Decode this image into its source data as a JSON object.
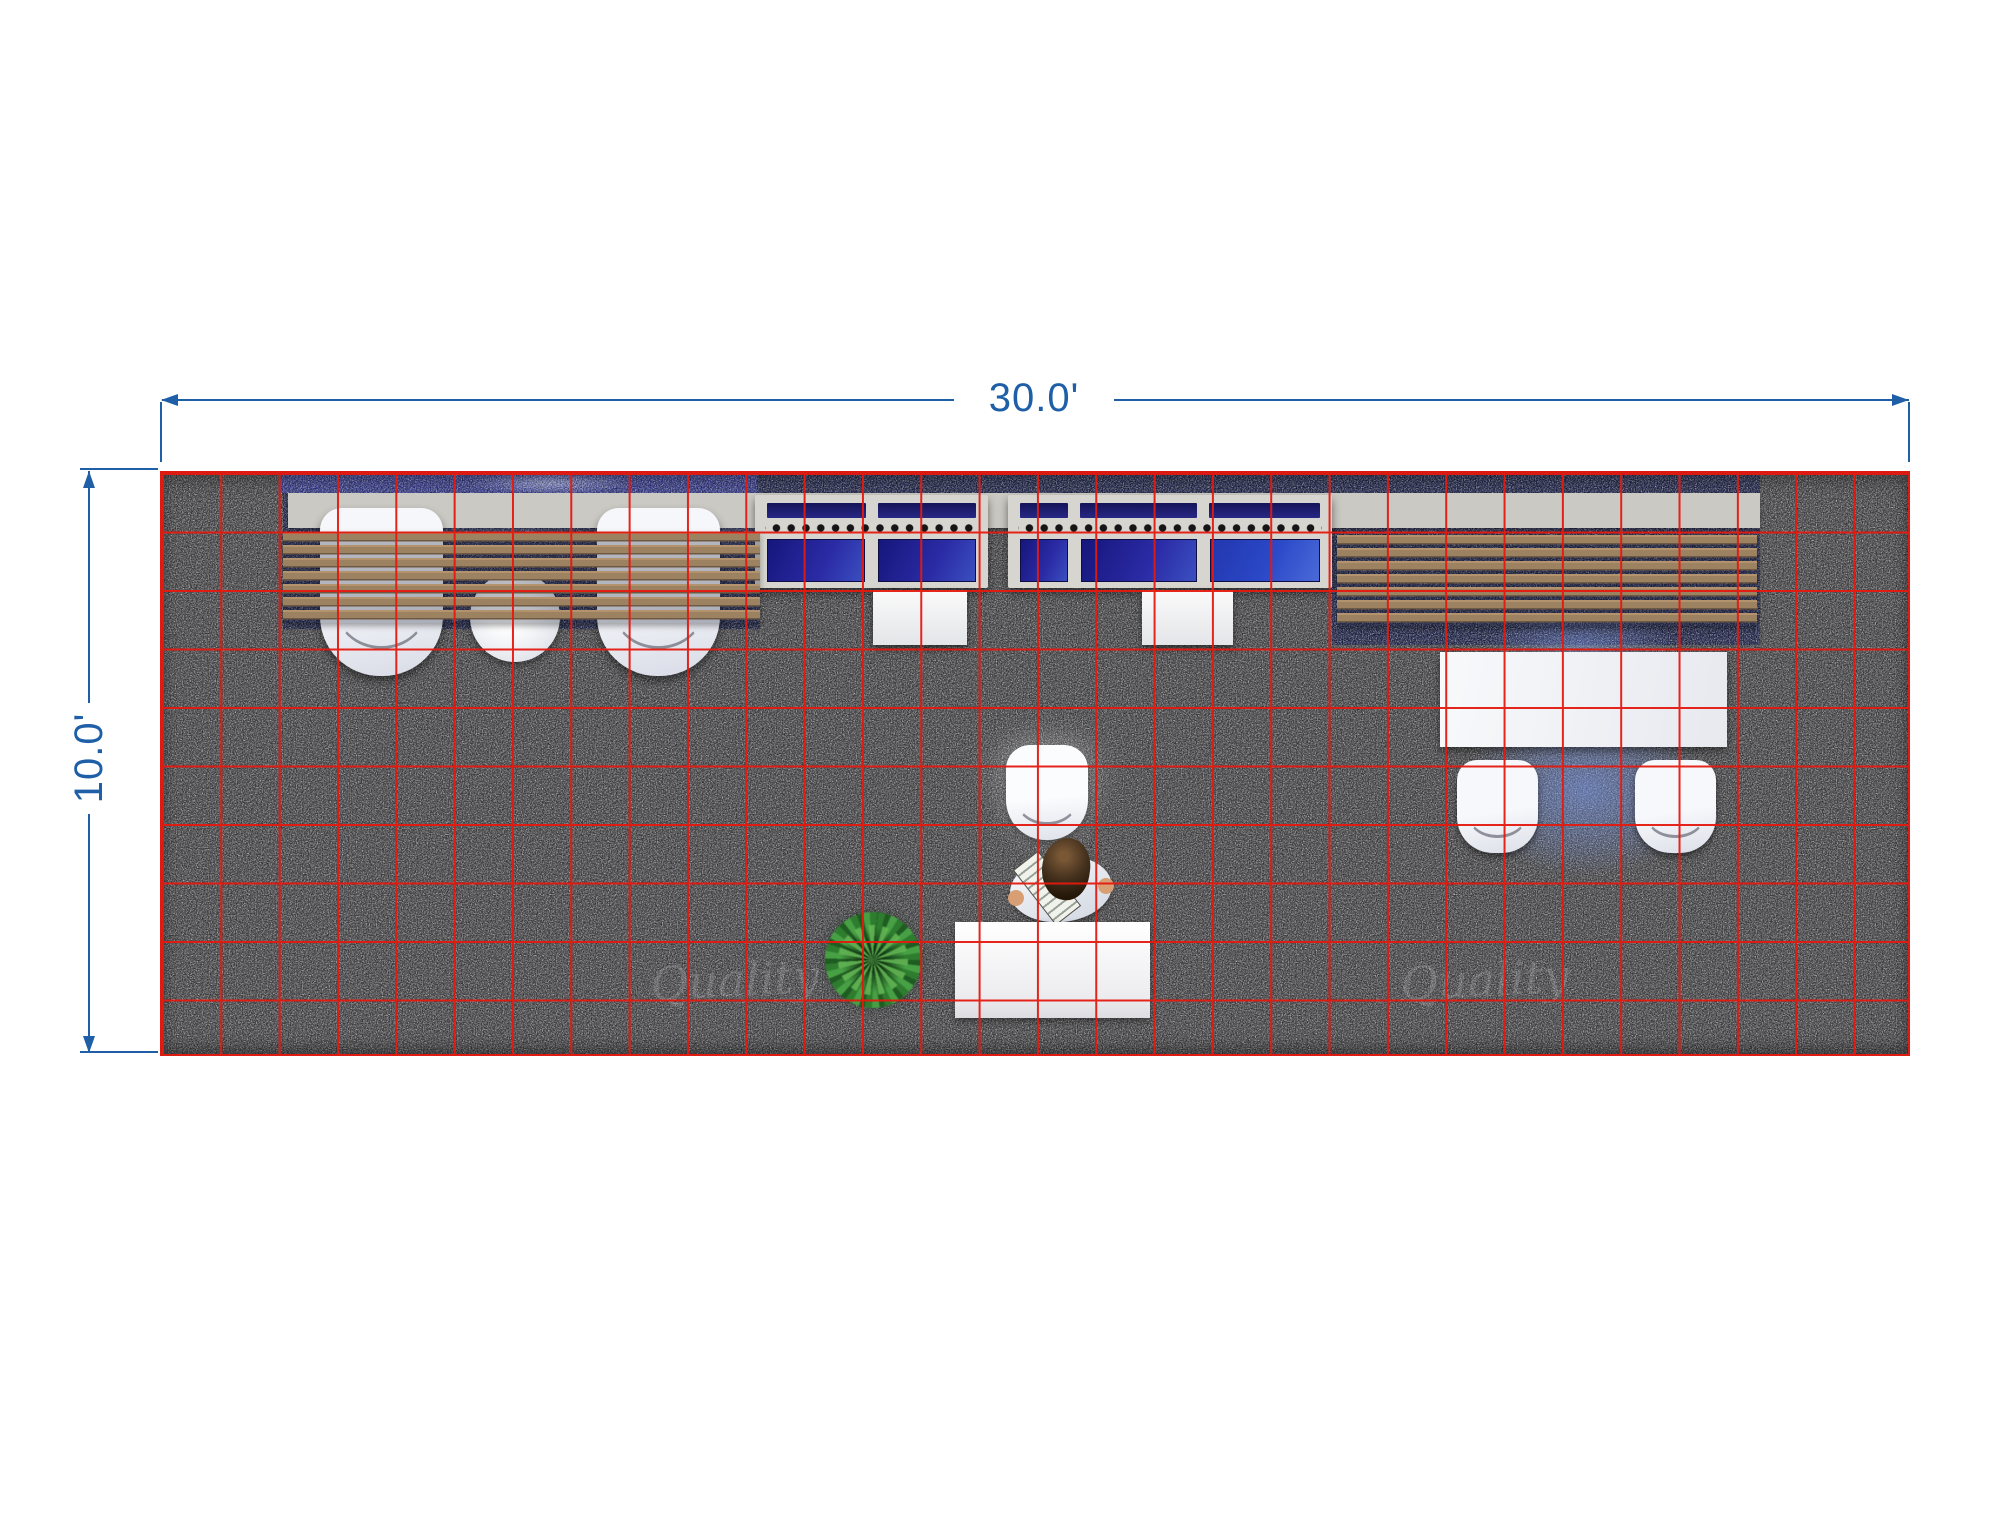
{
  "scene": {
    "title": "30ft x 10ft trade show booth — top view floor plan render",
    "background_color": "#ffffff"
  },
  "dimensions": {
    "width_label": "30.0'",
    "depth_label": "10.0'",
    "line_color": "#1e5fa8"
  },
  "floor_grid": {
    "columns": 30,
    "rows": 10,
    "cell_feet": 1,
    "line_color": "#e5190f",
    "carpet_color": "#515154"
  },
  "booth": {
    "back_wall": {
      "panel_color": "#cbc9c3",
      "blue_header_color": "#3d43a0",
      "navy_carpet_color": "#252b55"
    },
    "left_lounge": {
      "slat_count": 7,
      "slat_color": "#a88c69",
      "lounge_chairs": 2,
      "round_tables": 1
    },
    "display_counters": {
      "units": 2,
      "screen_color": "#22229a",
      "led_dot_color": "#151515",
      "pedestals": 2
    },
    "right_lounge": {
      "slat_count": 7,
      "slat_color": "#a88c69",
      "tables": 1,
      "chairs": 2
    },
    "reception": {
      "desks": 1,
      "chairs": 1,
      "people": 1,
      "plants": 1
    }
  },
  "watermark": {
    "text": "Quality"
  }
}
